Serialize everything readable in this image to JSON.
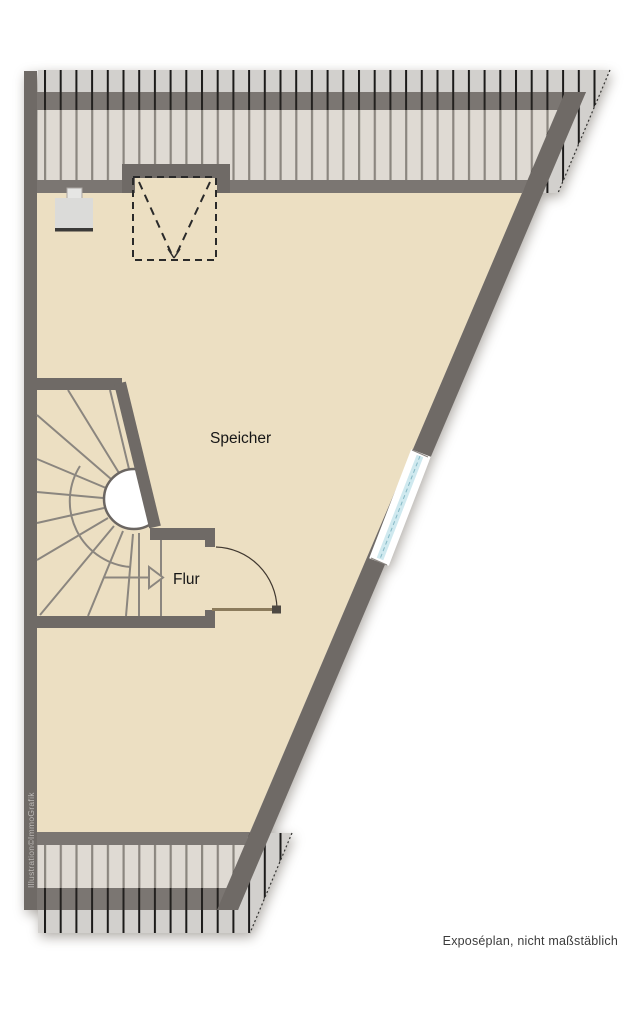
{
  "floorplan": {
    "type": "attic-floor-plan",
    "rooms": [
      {
        "label": "Speicher"
      },
      {
        "label": "Flur"
      }
    ],
    "features": {
      "staircase": "winder-staircase-with-direction-arrow",
      "door": "hinged-door-swinging-into-speicher",
      "window": "window-in-slanted-exterior-wall",
      "dormer": "dashed-roof-opening-with-v-symbol",
      "chimney": "chimney-block-at-top-left"
    },
    "footer": {
      "disclaimer": "Exposéplan, nicht maßstäblich"
    },
    "watermark": {
      "credit": "Illustration©ImmoGrafik"
    },
    "colors": {
      "background": "#FFFFFF",
      "floor": "#ECDFC2",
      "wall": "#6F6A66",
      "knee_wall": "#7B7672",
      "eaves_hatch_bg": "#D2D0CD",
      "eaves_hatch_line": "#1C1B1A",
      "inner_hatch_bg": "#DFDAD3",
      "inner_hatch_line": "#8B867F",
      "stair_line": "#8B867F",
      "window_glass": "#CFE9EF",
      "window_glass_edge": "#85B9C6",
      "door_leaf": "#8B7B5C"
    }
  }
}
